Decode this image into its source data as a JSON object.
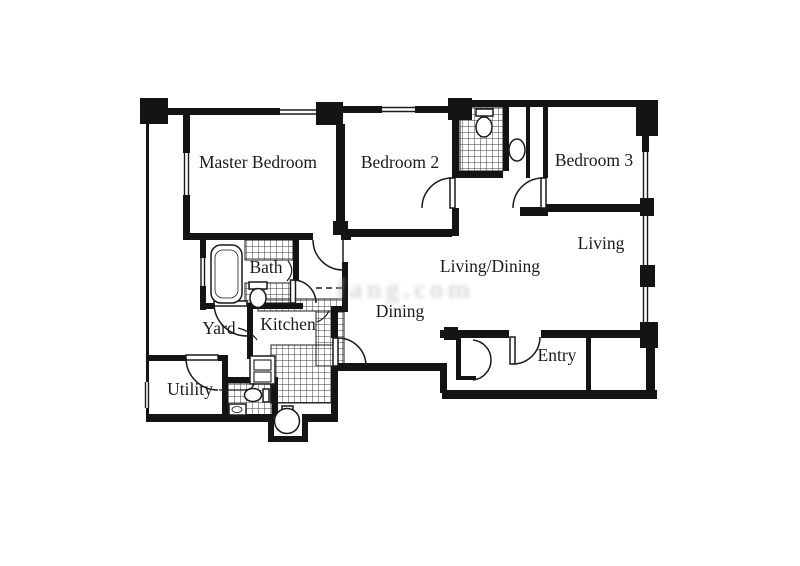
{
  "plan": {
    "type": "apartment-floor-plan",
    "watermark": "fang.com",
    "colors": {
      "wall": "#141414",
      "floor": "#ffffff",
      "tile_line": "#3d3d3d",
      "label": "#1b1b1b",
      "watermark": "#bdbdbd"
    },
    "fixtures": [
      "bathtub-icon",
      "toilet-icon",
      "toilet-icon",
      "toilet-icon",
      "sink-icon",
      "sink-icon",
      "kitchen-sink-icon",
      "water-heater-icon",
      "door-arc-icon",
      "window-icon",
      "column-icon",
      "tiled-floor-icon"
    ]
  },
  "rooms": [
    {
      "id": "master-bedroom",
      "label": "Master Bedroom"
    },
    {
      "id": "bedroom-2",
      "label": "Bedroom 2"
    },
    {
      "id": "bedroom-3",
      "label": "Bedroom 3"
    },
    {
      "id": "living",
      "label": "Living"
    },
    {
      "id": "living-dining",
      "label": "Living/Dining"
    },
    {
      "id": "dining",
      "label": "Dining"
    },
    {
      "id": "bath",
      "label": "Bath"
    },
    {
      "id": "yard",
      "label": "Yard"
    },
    {
      "id": "kitchen",
      "label": "Kitchen"
    },
    {
      "id": "utility",
      "label": "Utility"
    },
    {
      "id": "entry",
      "label": "Entry"
    }
  ]
}
